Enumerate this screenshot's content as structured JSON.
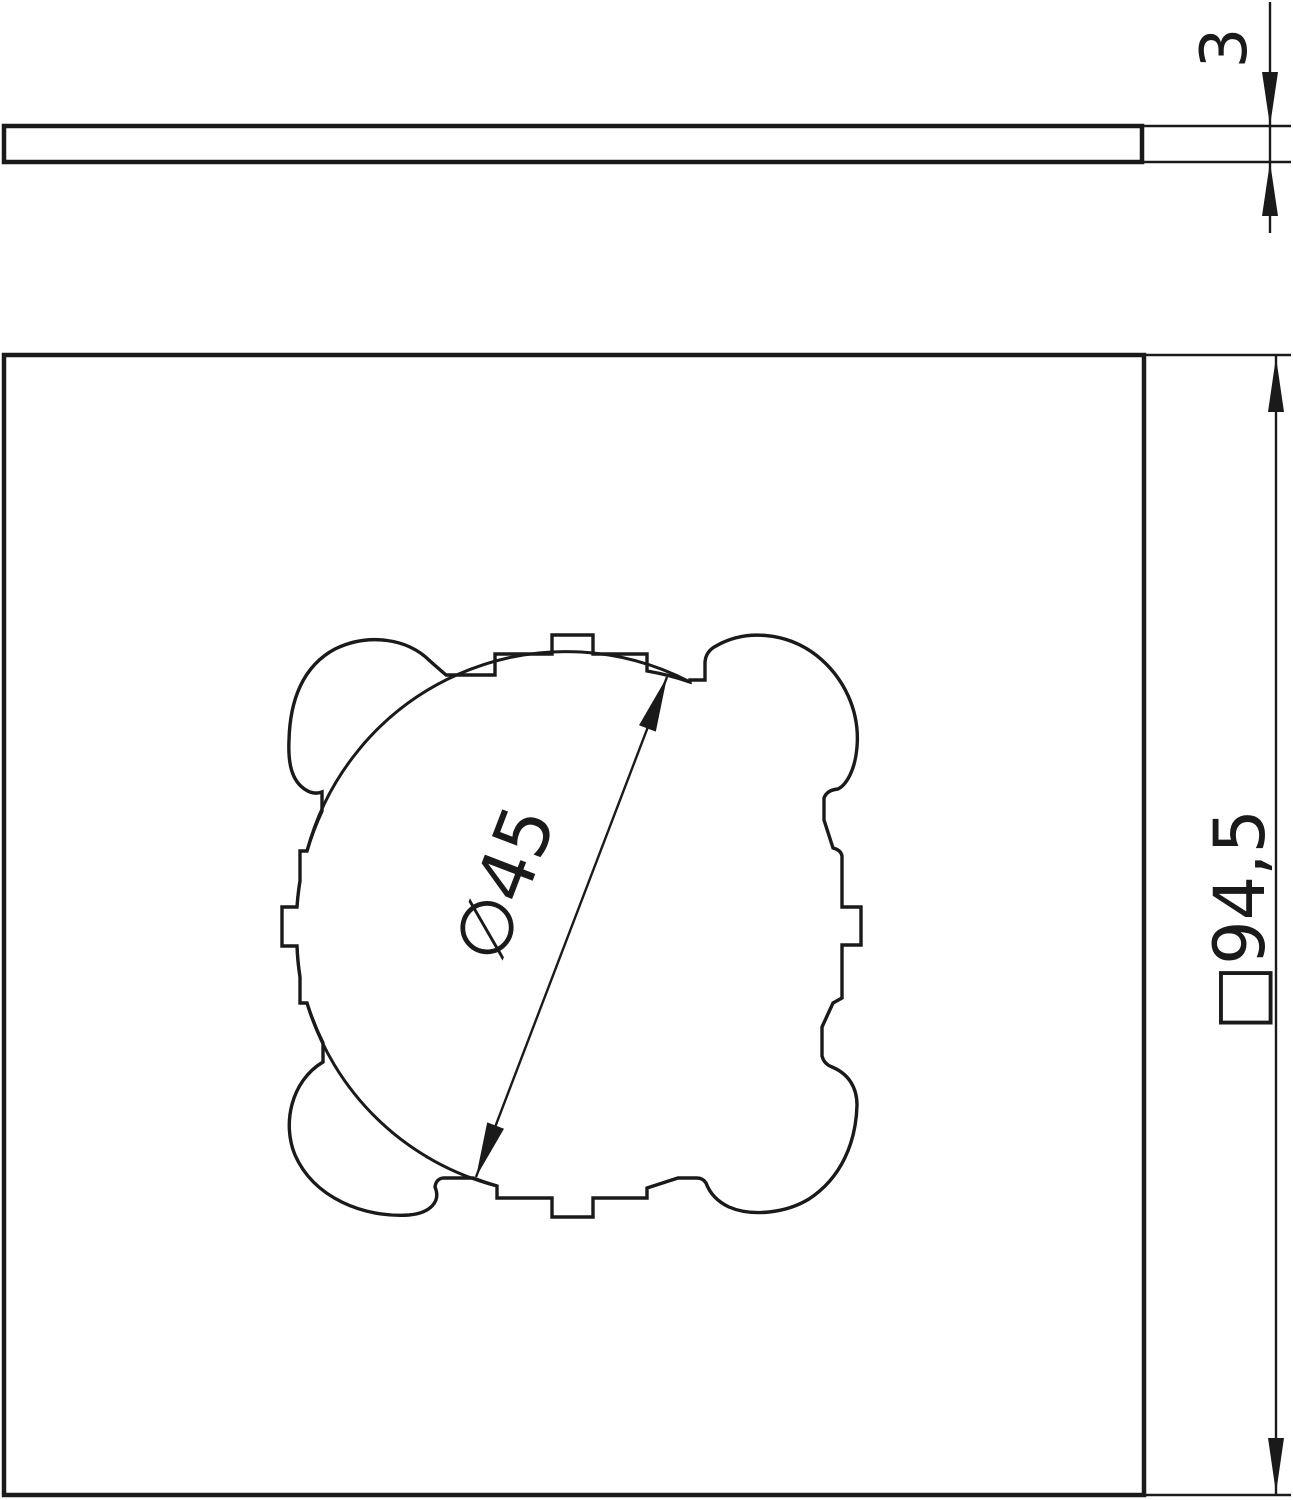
{
  "drawing": {
    "type": "technical-drawing",
    "side_view": {
      "thickness_label": "3"
    },
    "front_view": {
      "outer_size_label": "□94,5",
      "cutout_diameter_label": "∅45"
    }
  },
  "colors": {
    "line": "#1a1a1a",
    "background": "#ffffff"
  }
}
